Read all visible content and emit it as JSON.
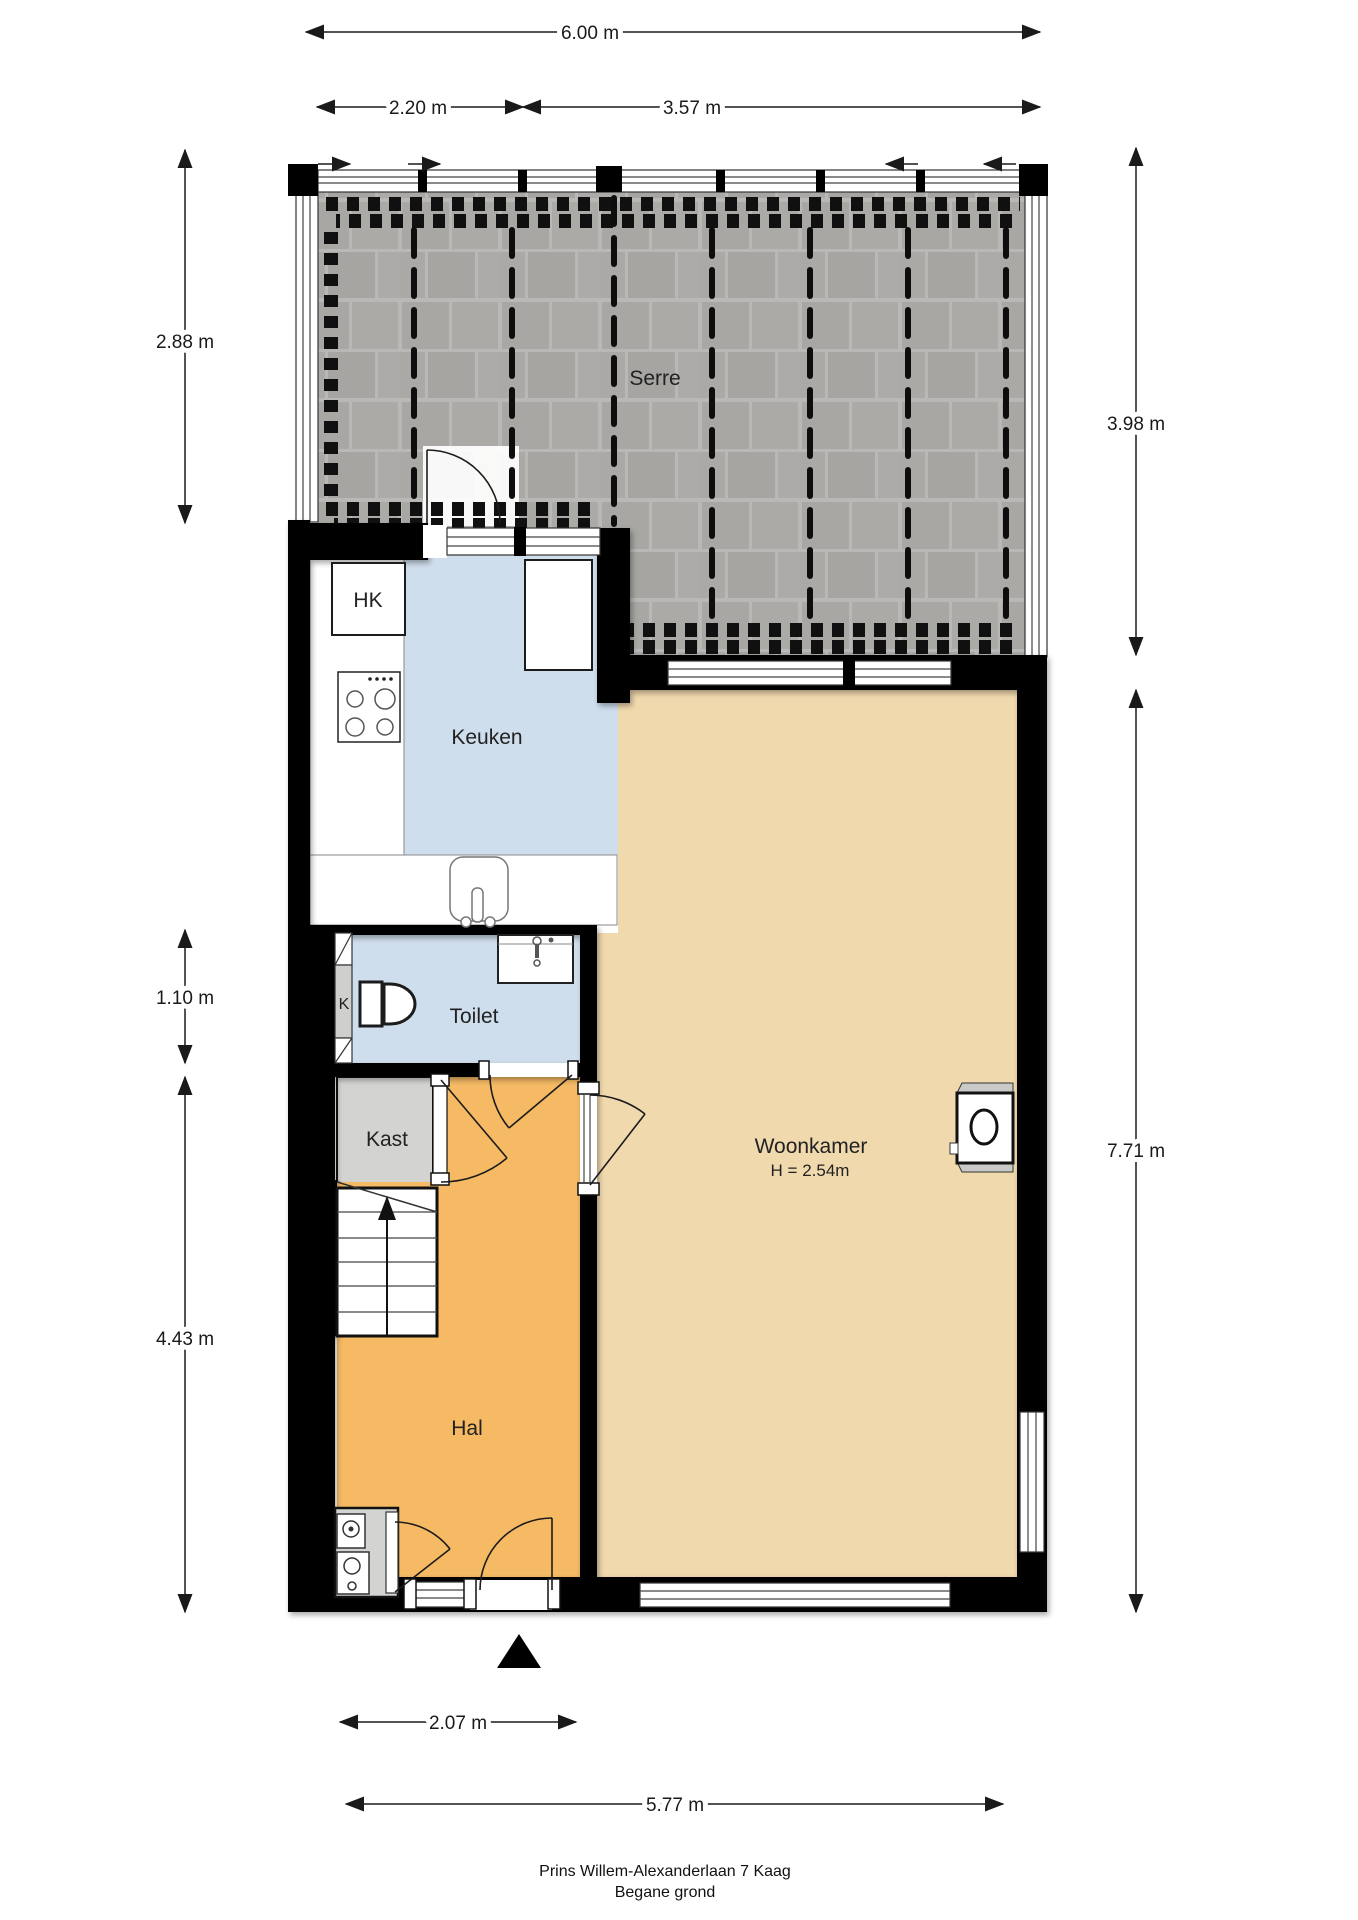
{
  "labels": {
    "serre": "Serre",
    "keuken": "Keuken",
    "hk": "HK",
    "toilet": "Toilet",
    "meter_k": "K",
    "kast": "Kast",
    "hal": "Hal",
    "woonkamer": "Woonkamer",
    "woonkamer_ceiling": "H = 2.54m"
  },
  "dimensions": {
    "width_total": "6.00 m",
    "width_left": "2.20 m",
    "width_right": "3.57 m",
    "left_serre": "2.88 m",
    "left_toilet": "1.10 m",
    "left_hal": "4.43 m",
    "right_serre": "3.98 m",
    "right_woonkamer": "7.71 m",
    "bottom_entrance": "2.07 m",
    "bottom_total": "5.77 m"
  },
  "footer": {
    "address": "Prins Willem-Alexanderlaan 7 Kaag",
    "floor": "Begane grond"
  },
  "colors": {
    "wall": "#000000",
    "hal_floor": "#f6ba64",
    "woonkamer_floor": "#f1d9ae",
    "wet_room_floor": "#cfdeed",
    "kast_floor": "#d3d3d1",
    "serre_tile": "#a8a7a4",
    "serre_joint": "#b9b8b6"
  }
}
